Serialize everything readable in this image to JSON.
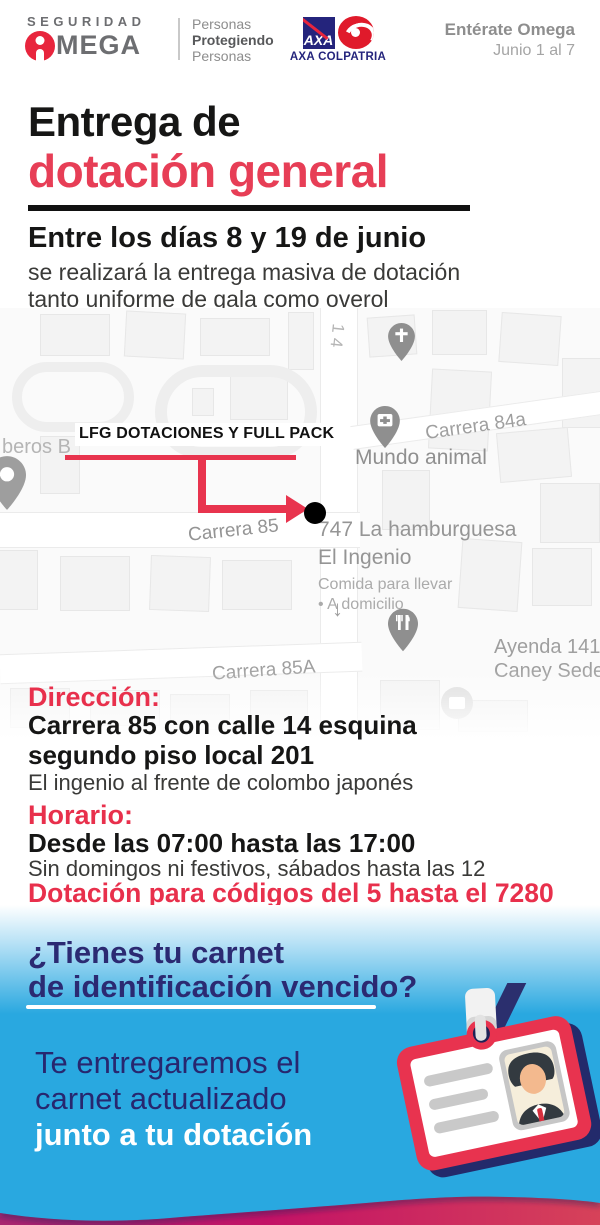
{
  "header": {
    "brand": {
      "seguridad": "SEGURIDAD",
      "mega": "MEGA",
      "tagline_1": "Personas",
      "tagline_2": "Protegiendo",
      "tagline_3": "Personas"
    },
    "axa": {
      "square_label": "AXA",
      "name": "AXA COLPATRIA"
    },
    "edition": {
      "title": "Entérate Omega",
      "dates": "Junio 1 al 7"
    }
  },
  "title": {
    "line1": "Entrega de",
    "line2": "dotación general"
  },
  "intro": {
    "heading": "Entre los días 8 y 19 de junio",
    "body_1": "se realizará la entrega masiva de dotación",
    "body_2": "tanto uniforme de gala como overol"
  },
  "map": {
    "callout": "LFG DOTACIONES Y FULL PACK",
    "labels": {
      "street_14": "14",
      "bomberos": "beros B",
      "carrera_84a": "Carrera 84a",
      "mundo_animal": "Mundo animal",
      "carrera_85": "Carrera 85",
      "hamburguesa_1": "747 La hamburguesa",
      "hamburguesa_2": "El Ingenio",
      "hamburguesa_3": "Comida para llevar",
      "hamburguesa_4": "• A domicilio",
      "carrera_85a": "Carrera 85A",
      "ayenda_1": "Ayenda 141",
      "ayenda_2": "Caney Sede",
      "oneway_arrow": "↓"
    }
  },
  "direccion": {
    "heading": "Dirección:",
    "line1": "Carrera 85 con calle 14 esquina",
    "line2": "segundo piso local 201",
    "note": "El ingenio al frente de colombo japonés"
  },
  "horario": {
    "heading": "Horario:",
    "hours": "Desde las 07:00  hasta las 17:00",
    "note": "Sin domingos ni festivos, sábados hasta las 12"
  },
  "codes_notice": "Dotación para códigos del 5 hasta el 7280",
  "carnet": {
    "question_1": "¿Tienes tu carnet",
    "question_2": "de identificación vencido?",
    "answer_1": "Te entregaremos el",
    "answer_2": "carnet actualizado",
    "answer_3": "junto a tu dotación"
  },
  "colors": {
    "accent_red": "#E73E56",
    "line_red": "#E8344E",
    "navy": "#2B2A72",
    "sky_blue": "#29A8E0",
    "magenta": "#C31266",
    "crimson": "#D64259",
    "logo_gray": "#6D6E71",
    "axa_navy": "#24247C"
  }
}
